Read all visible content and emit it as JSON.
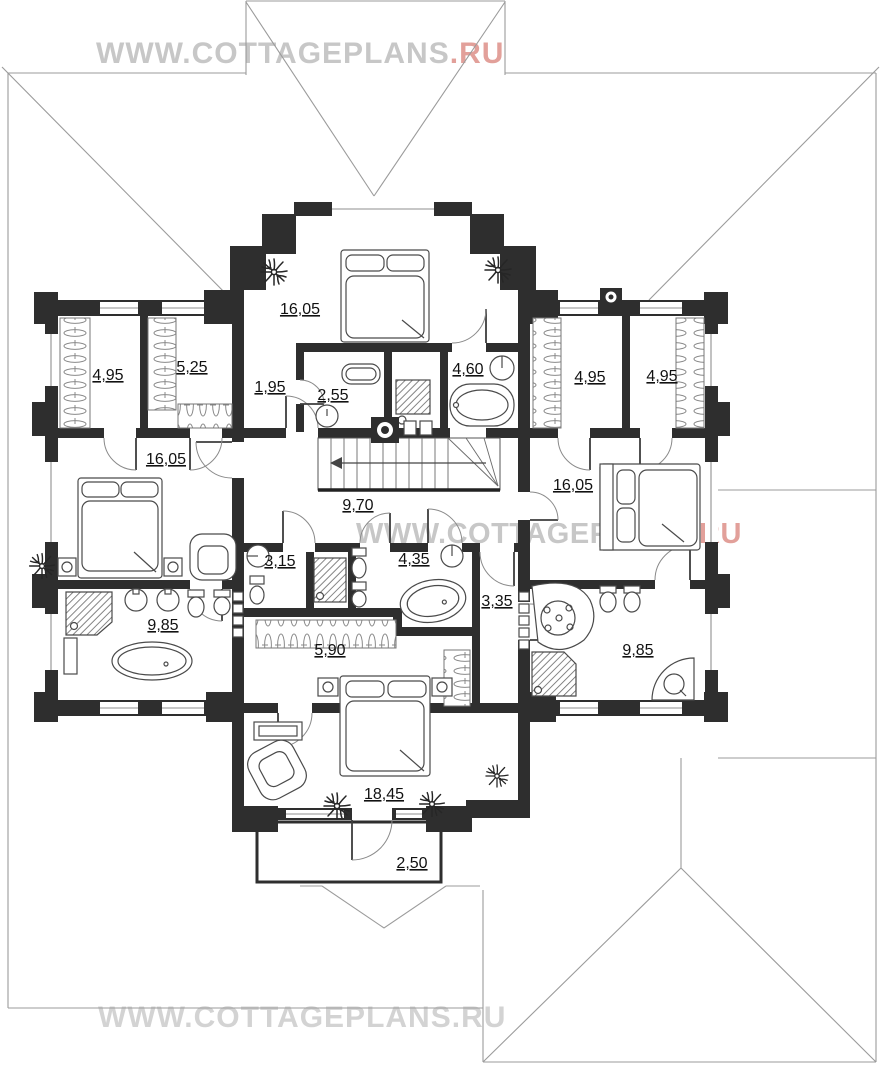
{
  "watermarks": {
    "top": {
      "text": "WWW.COTTAGEPLANS",
      "suffix": ".RU"
    },
    "middle": {
      "text": "WWW.COTTAGEPLANS",
      "suffix": ".RU"
    },
    "bottom": {
      "text": "WWW.COTTAGEPLANS.RU"
    }
  },
  "rooms": [
    {
      "name": "bedroom-top",
      "area": "16,05"
    },
    {
      "name": "wardrobe-left-1",
      "area": "4,95"
    },
    {
      "name": "wardrobe-left-2",
      "area": "5,25"
    },
    {
      "name": "vestibule",
      "area": "1,95"
    },
    {
      "name": "wc-small",
      "area": "2,55"
    },
    {
      "name": "bathroom-top",
      "area": "4,60"
    },
    {
      "name": "wardrobe-right-1",
      "area": "4,95"
    },
    {
      "name": "wardrobe-right-2",
      "area": "4,95"
    },
    {
      "name": "bedroom-left",
      "area": "16,05"
    },
    {
      "name": "stair-hall",
      "area": "9,70"
    },
    {
      "name": "bedroom-right",
      "area": "16,05"
    },
    {
      "name": "wc-1",
      "area": "3,15"
    },
    {
      "name": "bathroom-mid",
      "area": "4,35"
    },
    {
      "name": "corridor",
      "area": "3,35"
    },
    {
      "name": "bathroom-left",
      "area": "9,85"
    },
    {
      "name": "wardrobe-center",
      "area": "5,90"
    },
    {
      "name": "bathroom-right",
      "area": "9,85"
    },
    {
      "name": "bedroom-bottom",
      "area": "18,45"
    },
    {
      "name": "balcony",
      "area": "2,50"
    }
  ],
  "colors": {
    "wall_color": "#2e2e2e",
    "roof_color": "#9b9b9b",
    "furniture_color": "#4a4a4a",
    "label_color": "#111111",
    "wm_gray": "#c7c7c7",
    "wm_gray_light": "#d3d3d3",
    "wm_red": "#e2a09a"
  }
}
